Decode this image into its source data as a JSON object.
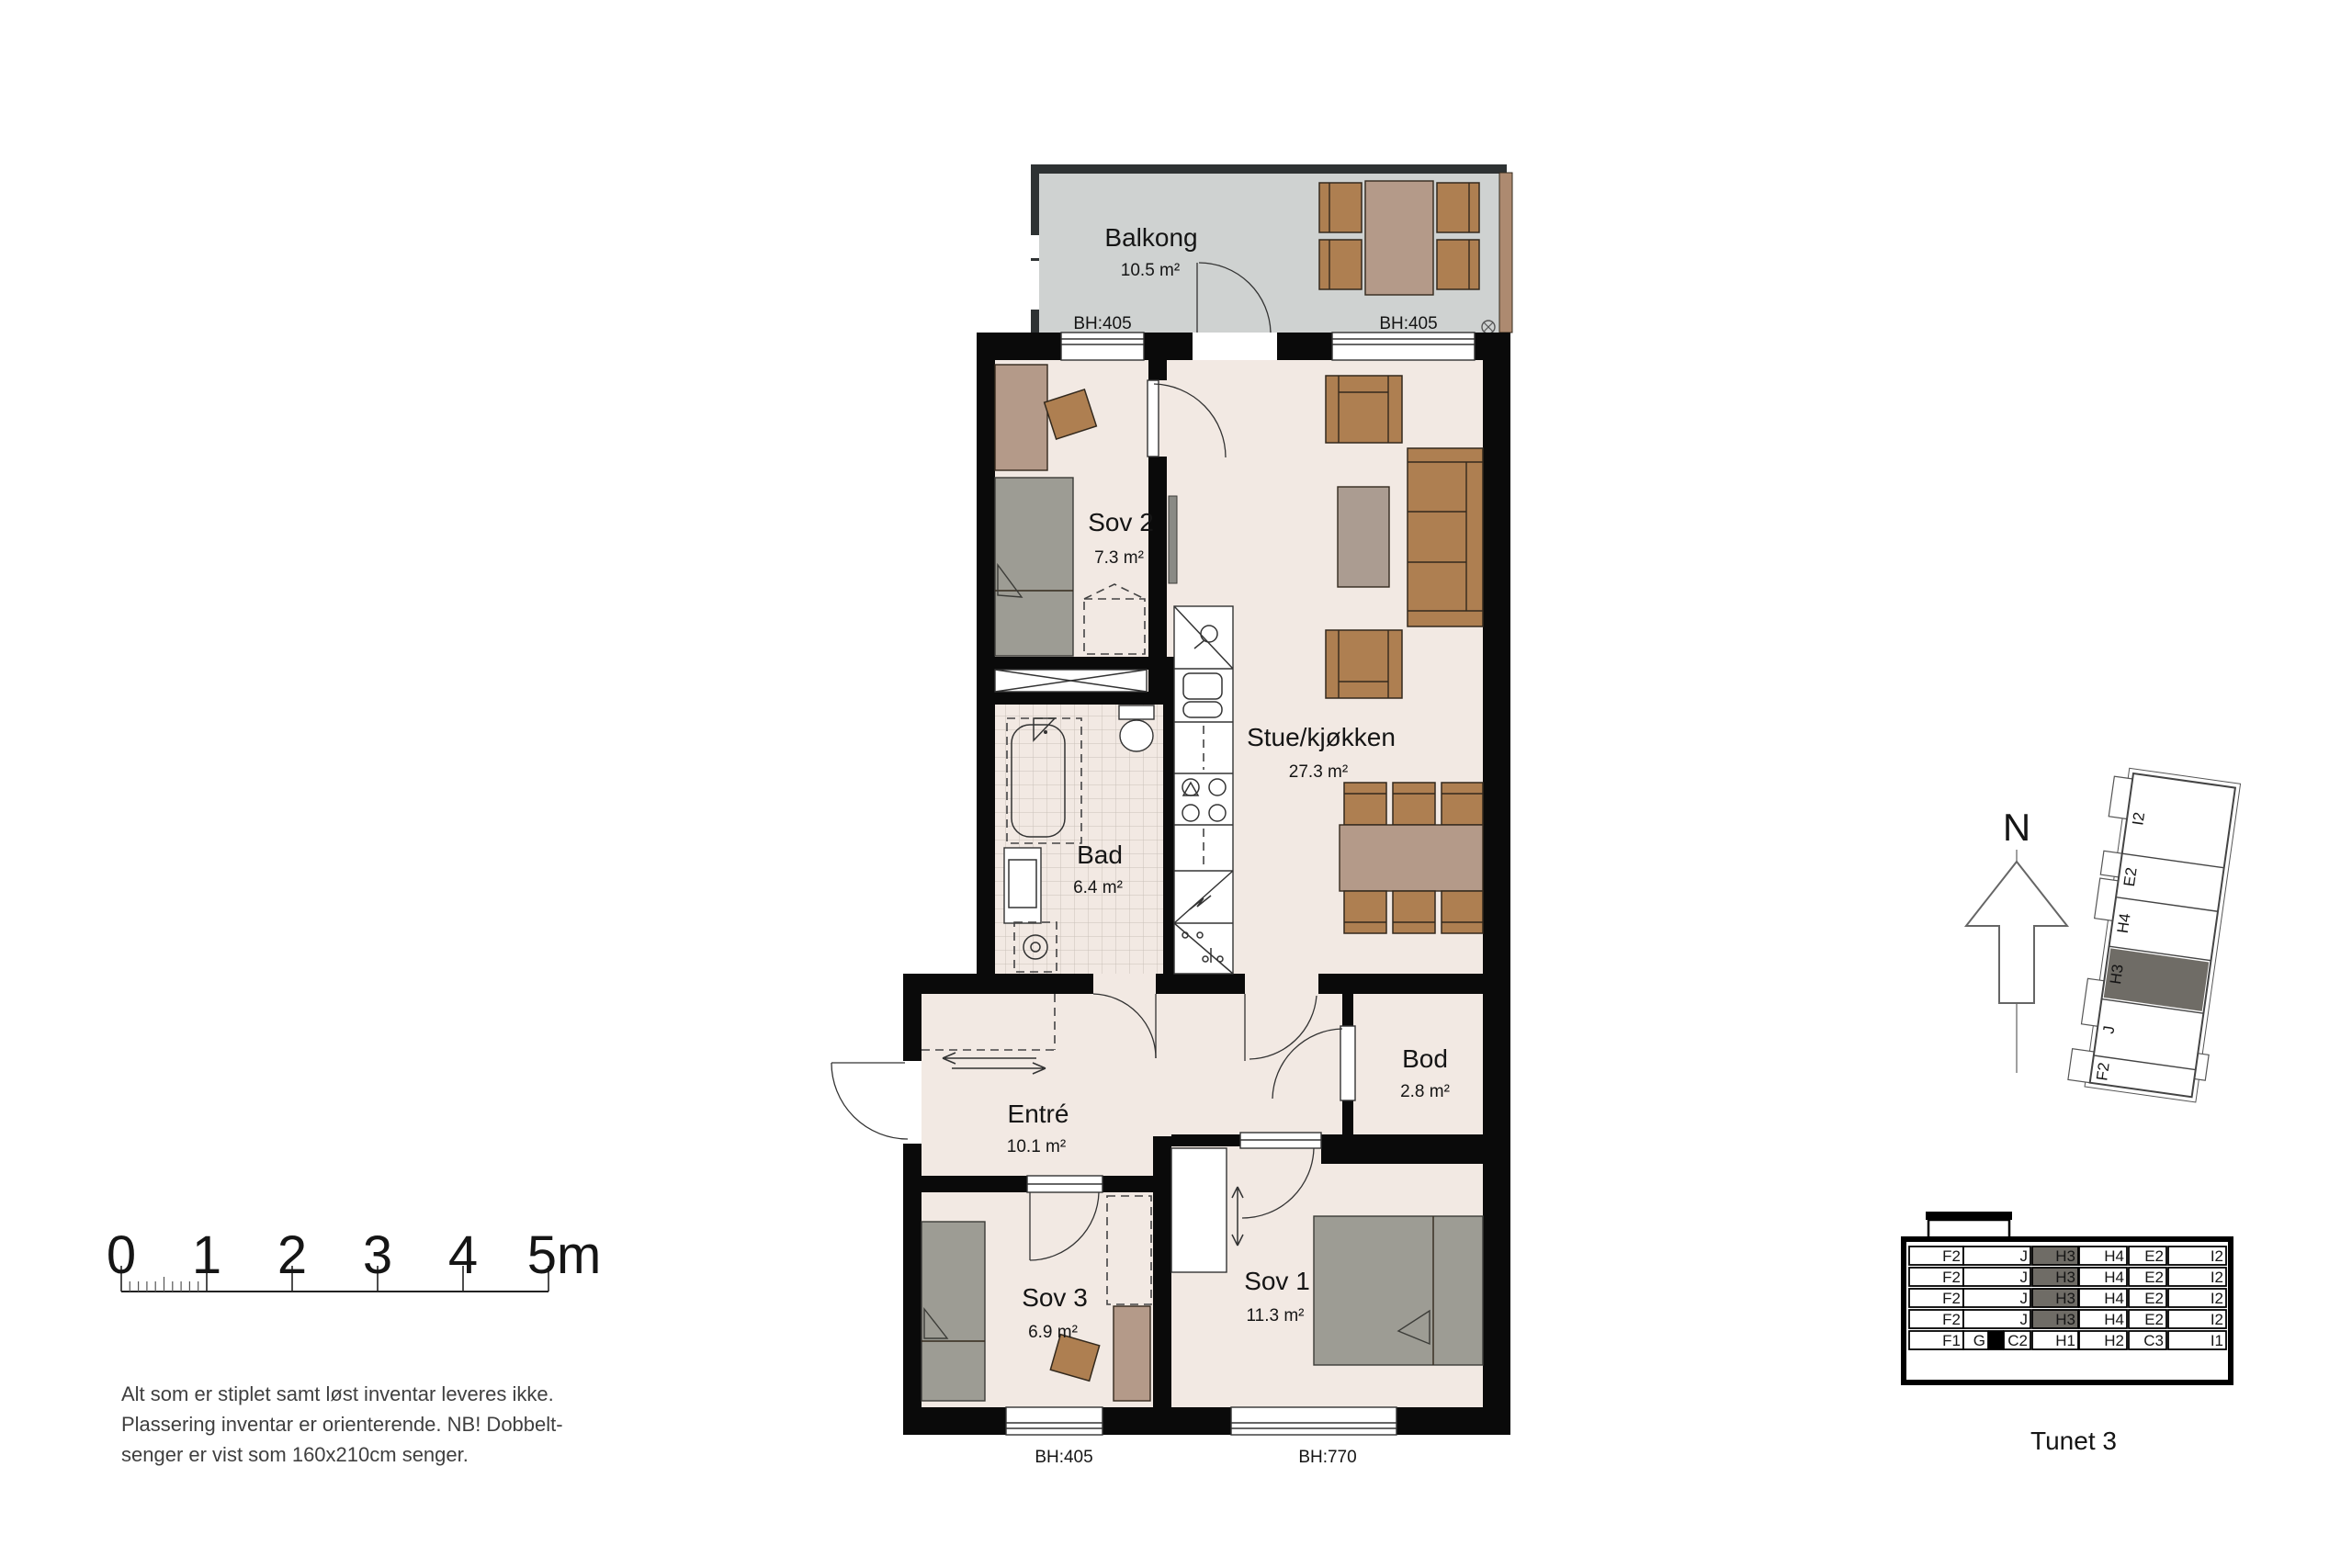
{
  "rooms": {
    "balkong": {
      "name": "Balkong",
      "area": "10.5 m²"
    },
    "sov2": {
      "name": "Sov 2",
      "area": "7.3 m²"
    },
    "stue": {
      "name": "Stue/kjøkken",
      "area": "27.3 m²"
    },
    "bad": {
      "name": "Bad",
      "area": "6.4 m²"
    },
    "entre": {
      "name": "Entré",
      "area": "10.1 m²"
    },
    "bod": {
      "name": "Bod",
      "area": "2.8 m²"
    },
    "sov3": {
      "name": "Sov 3",
      "area": "6.9 m²"
    },
    "sov1": {
      "name": "Sov 1",
      "area": "11.3 m²"
    }
  },
  "bh": {
    "balcony_left": "BH:405",
    "balcony_right": "BH:405",
    "sov3": "BH:405",
    "sov1": "BH:770"
  },
  "scale_bar": {
    "labels": [
      "0",
      "1",
      "2",
      "3",
      "4",
      "5m"
    ]
  },
  "notes": {
    "lines": [
      "Alt som er stiplet samt løst inventar leveres ikke.",
      "Plassering inventar er orienterende. NB! Dobbelt-",
      "senger er vist som 160x210cm senger."
    ]
  },
  "compass": {
    "north_label": "N"
  },
  "site_plan": {
    "units": [
      "I2",
      "E2",
      "H4",
      "H3",
      "J",
      "F2"
    ],
    "highlighted_unit": "H3"
  },
  "elevation": {
    "title": "Tunet 3",
    "highlighted_unit": "H3",
    "floors": [
      {
        "cells": [
          "F2",
          "J",
          "H3",
          "H4",
          "E2",
          "I2"
        ]
      },
      {
        "cells": [
          "F2",
          "J",
          "H3",
          "H4",
          "E2",
          "I2"
        ]
      },
      {
        "cells": [
          "F2",
          "J",
          "H3",
          "H4",
          "E2",
          "I2"
        ]
      },
      {
        "cells": [
          "F2",
          "J",
          "H3",
          "H4",
          "E2",
          "I2"
        ]
      }
    ],
    "ground": {
      "cells": [
        "F1",
        "G",
        "C2",
        "H1",
        "H2",
        "C3",
        "I1"
      ]
    }
  },
  "colors": {
    "wall": "#0a0a0a",
    "floor": "#f2e9e3",
    "balcony_floor": "#cfd2d1",
    "furniture_brown": "#ae7f51",
    "furniture_tan": "#b49a89",
    "furniture_gray": "#9d9c94",
    "highlight_gray": "#6f6c66"
  }
}
